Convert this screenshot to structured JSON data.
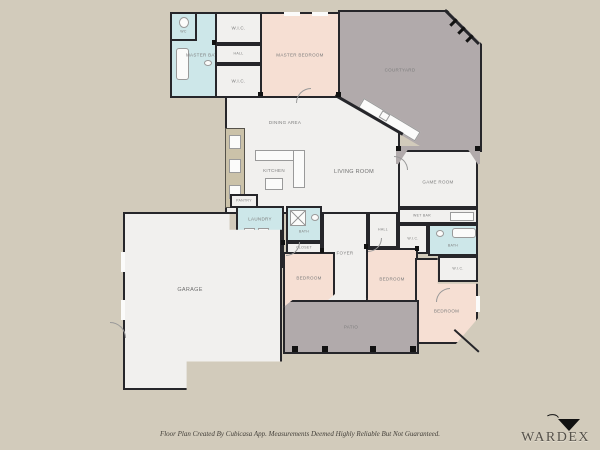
{
  "plan": {
    "rooms": {
      "master_bath": {
        "label": "MASTER BATH"
      },
      "wc_master": {
        "label": "WC"
      },
      "wic_top": {
        "label": "W.I.C."
      },
      "hall_top": {
        "label": "HALL"
      },
      "wic_mid": {
        "label": "W.I.C."
      },
      "master_bedroom": {
        "label": "MASTER BEDROOM"
      },
      "courtyard": {
        "label": "COURTYARD"
      },
      "dining": {
        "label": "DINING AREA"
      },
      "kitchen": {
        "label": "KITCHEN"
      },
      "living": {
        "label": "LIVING ROOM"
      },
      "pantry": {
        "label": "PANTRY"
      },
      "laundry": {
        "label": "LAUNDRY"
      },
      "wc_hall": {
        "label": "WC"
      },
      "bath_hall": {
        "label": "BATH"
      },
      "closet_hall": {
        "label": "CLOSET"
      },
      "foyer": {
        "label": "FOYER"
      },
      "hall_mid": {
        "label": "HALL"
      },
      "garage": {
        "label": "GARAGE"
      },
      "game_room": {
        "label": "GAME ROOM"
      },
      "wet_bar": {
        "label": "WET BAR"
      },
      "wic_right_a": {
        "label": "W.I.C."
      },
      "bath_right": {
        "label": "BATH"
      },
      "wic_right_b": {
        "label": "W.I.C."
      },
      "bedroom_1": {
        "label": "BEDROOM"
      },
      "bedroom_2": {
        "label": "BEDROOM"
      },
      "bedroom_3": {
        "label": "BEDROOM"
      },
      "patio": {
        "label": "PATIO"
      }
    },
    "colors": {
      "background": "#d2cbbb",
      "floor": "#f1f0ee",
      "bedroom_pink": "#f6dfd3",
      "bath_blue": "#cde7e9",
      "outdoor_gray": "#b1aaab",
      "wall": "#26262a"
    }
  },
  "footer": {
    "disclaimer": "Floor Plan Created By Cubicasa App. Measurements Deemed Highly Reliable But Not Guaranteed."
  },
  "watermark": {
    "brand": "WARDEX"
  }
}
